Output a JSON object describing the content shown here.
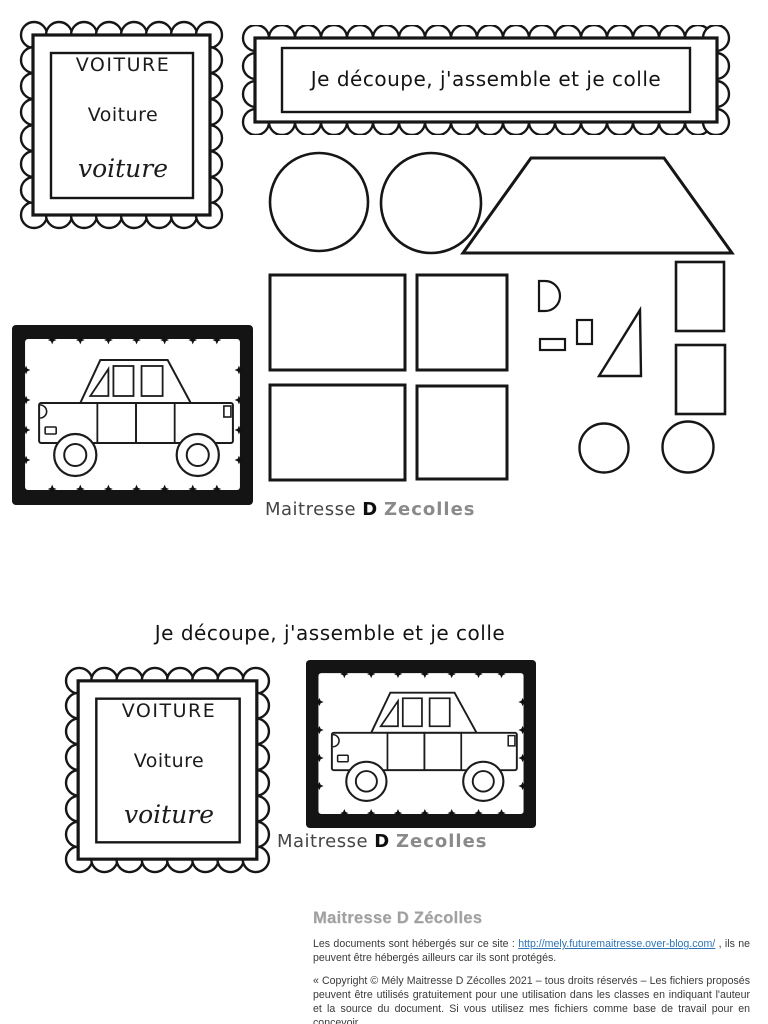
{
  "labels": {
    "word_caps": "VOITURE",
    "word_mixed": "Voiture",
    "word_cursive": "voiture"
  },
  "banner": {
    "title": "Je découpe, j'assemble et je colle"
  },
  "section2": {
    "title": "Je découpe, j'assemble et je colle"
  },
  "watermark": {
    "part1": "Maitresse",
    "part2": "D",
    "part3": "Zecolles"
  },
  "footer": {
    "title": "Maitresse D Zécolles",
    "para1_prefix": "Les documents sont hébergés sur ce site : ",
    "link_text": "http://mely.futuremaitresse.over-blog.com/",
    "para1_suffix": " ,  ils ne peuvent être hébergés ailleurs  car ils sont protégés.",
    "para2": "« Copyright © Mély Maitresse D Zécolles 2021 – tous droits réservés – Les fichiers proposés peuvent être utilisés gratuitement pour une utilisation dans les classes en indiquant l'auteur et la source du document. Si vous utilisez mes fichiers comme base de travail pour en concevoir"
  },
  "pieces": {
    "items": [
      "circle",
      "circle",
      "trapezoid",
      "rectangle",
      "square",
      "rectangle",
      "square",
      "d-shape",
      "small-rectangle",
      "small-rectangle",
      "right-triangle",
      "small-square",
      "small-square",
      "small-circle",
      "small-circle"
    ]
  },
  "colors": {
    "ink": "#161616",
    "link": "#2e75b6",
    "footer_text": "#3a3a3a",
    "footer_title": "#a0a0a0",
    "watermark_dark": "#454545",
    "watermark_light": "#8a8a8a"
  }
}
